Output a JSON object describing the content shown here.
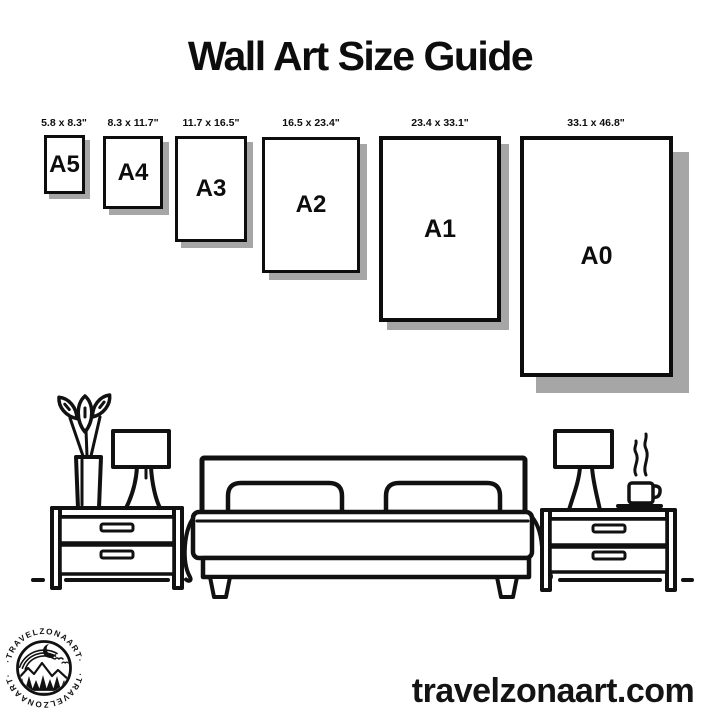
{
  "title": "Wall Art Size Guide",
  "size_guide": {
    "frames": [
      {
        "code": "A5",
        "dimensions_inches": "5.8 x 8.3\""
      },
      {
        "code": "A4",
        "dimensions_inches": "8.3 x 11.7\""
      },
      {
        "code": "A3",
        "dimensions_inches": "11.7 x 16.5\""
      },
      {
        "code": "A2",
        "dimensions_inches": "16.5 x 23.4\""
      },
      {
        "code": "A1",
        "dimensions_inches": "23.4 x 33.1\""
      },
      {
        "code": "A0",
        "dimensions_inches": "33.1 x 46.8\""
      }
    ]
  },
  "illustration": {
    "name": "bedroom-line-art",
    "elements": [
      "plant-in-vase",
      "left-table-lamp",
      "left-nightstand",
      "double-bed-with-two-pillows",
      "right-nightstand",
      "right-table-lamp",
      "steaming-coffee-cup",
      "floor-line"
    ]
  },
  "branding": {
    "logo_text_top": "·TRAVELZONAART·",
    "logo_text_bottom": "·TRAVELZONAART·",
    "website": "travelzonaart.com"
  },
  "colors": {
    "ink": "#111111",
    "frame_border": "#0d0d0d",
    "frame_shadow": "#a6a6a6",
    "background": "#ffffff"
  }
}
